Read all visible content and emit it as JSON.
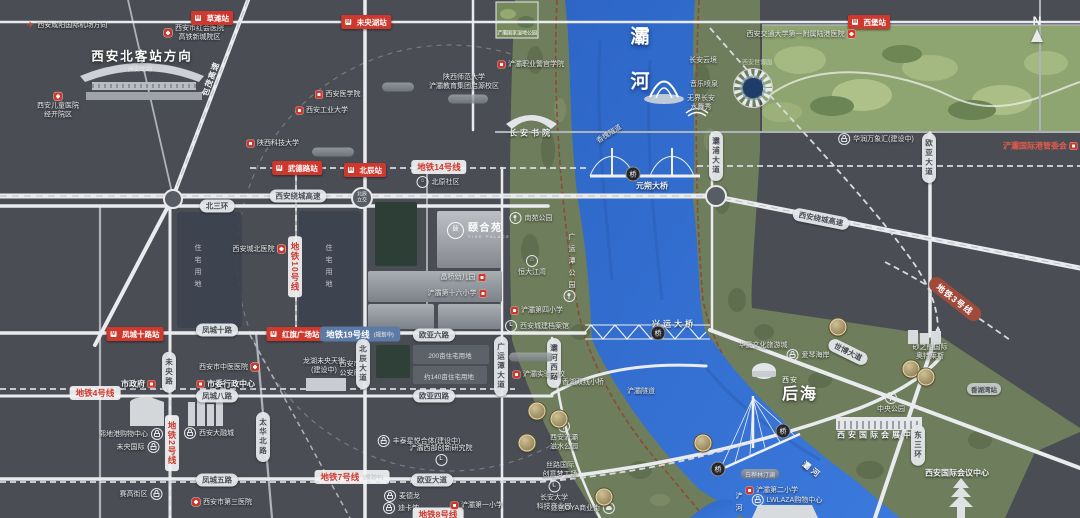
{
  "colors": {
    "map_bg": "#4a4e54",
    "river": "#3570cf",
    "corridor_green": "#6e7d5b",
    "expo_green": "#8ea471",
    "station_red": "#cf382c",
    "metro19_blue": "#5b7aa6",
    "metro3_brown": "#a04a3b",
    "gold_badge": "#c9b98c",
    "greenway": "#8a4c38"
  },
  "project": {
    "name": "颐合苑",
    "en": "YIHE PALACE"
  },
  "labels": [
    {
      "n": "airport-direction",
      "c": "pls",
      "t": "西安咸阳国际机场方向",
      "x": 67,
      "y": 25,
      "icon": "plane",
      "ip": "l"
    },
    {
      "n": "honghui-hospital",
      "c": "pls",
      "lines": [
        "西安市红会医院",
        "高铁新城院区"
      ],
      "x": 194,
      "y": 33,
      "icon": "cross",
      "ip": "l"
    },
    {
      "n": "station-caotan",
      "c": "st",
      "t": "草滩站",
      "x": 212,
      "y": 18
    },
    {
      "n": "station-weiyanghu",
      "c": "st",
      "t": "未央湖站",
      "x": 366,
      "y": 22
    },
    {
      "n": "station-xipu",
      "c": "st",
      "t": "西堡站",
      "x": 869,
      "y": 22
    },
    {
      "n": "north-station-direction",
      "c": "plb",
      "t": "西安北客站方向",
      "x": 142,
      "y": 55
    },
    {
      "n": "north-station-name",
      "c": "fade",
      "t": "西安北站",
      "x": 140,
      "y": 69
    },
    {
      "n": "children-hospital",
      "c": "pls col",
      "lines": [
        "西安儿童医院",
        "经开院区"
      ],
      "x": 58,
      "y": 106,
      "icon": "cross",
      "ip": "t"
    },
    {
      "n": "baomao-expressway",
      "c": "rdt",
      "t": "包茂高速",
      "x": 211,
      "y": 79,
      "rot": -70
    },
    {
      "n": "xian-medical-college",
      "c": "pls",
      "t": "西安医学院",
      "x": 338,
      "y": 94,
      "icon": "school",
      "ip": "l"
    },
    {
      "n": "xian-technological-university",
      "c": "pls",
      "t": "西安工业大学",
      "x": 322,
      "y": 110,
      "icon": "school",
      "ip": "l"
    },
    {
      "n": "shaanxi-ust",
      "c": "pls",
      "t": "陕西科技大学",
      "x": 273,
      "y": 143,
      "icon": "school",
      "ip": "l"
    },
    {
      "n": "station-wudelu",
      "c": "st",
      "t": "武德路站",
      "x": 297,
      "y": 168
    },
    {
      "n": "metro-line-14",
      "c": "mt14",
      "t": "地铁14号线",
      "x": 439,
      "y": 167
    },
    {
      "n": "station-beichen",
      "c": "st",
      "t": "北辰站",
      "x": 365,
      "y": 170
    },
    {
      "n": "beiyuan-community",
      "c": "pls",
      "t": "北原社区",
      "x": 438,
      "y": 182,
      "icon": "home",
      "ip": "l"
    },
    {
      "n": "beichen-interchange",
      "c": "circ",
      "lines": [
        "北辰",
        "立交"
      ],
      "x": 362,
      "y": 198
    },
    {
      "n": "ring-expressway-west",
      "c": "rd",
      "t": "西安绕城高速",
      "x": 298,
      "y": 196
    },
    {
      "n": "north-3rd-ring",
      "c": "rd",
      "t": "北三环",
      "x": 217,
      "y": 206
    },
    {
      "n": "residential-zone-1",
      "c": "zone",
      "t": "住宅用地",
      "x": 197,
      "y": 268
    },
    {
      "n": "residential-zone-2",
      "c": "zone",
      "t": "住宅用地",
      "x": 328,
      "y": 268
    },
    {
      "n": "chengbei-hospital",
      "c": "pls",
      "t": "西安城北医院",
      "x": 259,
      "y": 249,
      "icon": "cross",
      "ip": "r"
    },
    {
      "n": "metro-line-10",
      "c": "mt14 v",
      "t": "地铁10号线",
      "x": 295,
      "y": 267
    },
    {
      "n": "station-fengchengshilu",
      "c": "st",
      "t": "凤城十路站",
      "x": 135,
      "y": 334
    },
    {
      "n": "fengcheng-10-road",
      "c": "rd",
      "t": "凤城十路",
      "x": 217,
      "y": 330
    },
    {
      "n": "station-hongqi-square",
      "c": "st",
      "t": "红旗广场站",
      "x": 295,
      "y": 334
    },
    {
      "n": "metro-line-19",
      "c": "mtb",
      "t": "地铁19号线",
      "x": 360,
      "y": 334,
      "tag": "(规划中)"
    },
    {
      "n": "ouya-6-road",
      "c": "rd",
      "t": "欧亚六路",
      "x": 434,
      "y": 335
    },
    {
      "n": "metro-line-4",
      "c": "mt14",
      "t": "地铁4号线",
      "x": 95,
      "y": 393
    },
    {
      "n": "city-government",
      "c": "pl",
      "t": "市政府",
      "x": 138,
      "y": 384,
      "icon": "school",
      "ip": "r"
    },
    {
      "n": "municipal-admin-center",
      "c": "pl",
      "t": "市委行政中心",
      "x": 226,
      "y": 384,
      "icon": "school",
      "ip": "l"
    },
    {
      "n": "tcm-hospital",
      "c": "pls",
      "t": "西安市中医医院",
      "x": 229,
      "y": 367,
      "icon": "cross",
      "ip": "r"
    },
    {
      "n": "fengcheng-8-road",
      "c": "rd",
      "t": "凤城八路",
      "x": 217,
      "y": 396
    },
    {
      "n": "weiyang-road",
      "c": "rdv",
      "t": "未央路",
      "x": 169,
      "y": 372
    },
    {
      "n": "metro-line-2",
      "c": "mt14 v",
      "t": "地铁2号线",
      "x": 172,
      "y": 443
    },
    {
      "n": "taihua-north-road",
      "c": "rdv",
      "t": "太华北路",
      "x": 263,
      "y": 437
    },
    {
      "n": "xidigang-mall",
      "c": "pls",
      "t": "熙地港购物中心",
      "x": 131,
      "y": 434,
      "icon": "bag",
      "ip": "r"
    },
    {
      "n": "weiyang-international",
      "c": "pls",
      "t": "未央国际",
      "x": 138,
      "y": 447,
      "icon": "bag",
      "ip": "r"
    },
    {
      "n": "darongcheng-mall",
      "c": "pls",
      "t": "西安大融城",
      "x": 209,
      "y": 433,
      "icon": "bag",
      "ip": "l"
    },
    {
      "n": "longfor-tianjie",
      "c": "pls col",
      "lines": [
        "龙湖未央天街",
        "(建设中)"
      ],
      "x": 324,
      "y": 366
    },
    {
      "n": "public-security-bureau",
      "c": "pls col",
      "lines": [
        "西安市",
        "公安局"
      ],
      "x": 350,
      "y": 369
    },
    {
      "n": "fengcheng-5-road",
      "c": "rd",
      "t": "凤城五路",
      "x": 217,
      "y": 480
    },
    {
      "n": "metro-line-7",
      "c": "mt14",
      "t": "地铁7号线",
      "x": 352,
      "y": 477,
      "tag": "(规划中)"
    },
    {
      "n": "ouya-avenue",
      "c": "rd",
      "t": "欧亚大道",
      "x": 432,
      "y": 480
    },
    {
      "n": "saigao-block",
      "c": "pls",
      "t": "赛高街区",
      "x": 141,
      "y": 494,
      "icon": "bag",
      "ip": "r"
    },
    {
      "n": "third-hospital",
      "c": "pls",
      "t": "西安市第三医院",
      "x": 222,
      "y": 502,
      "icon": "cross",
      "ip": "l"
    },
    {
      "n": "metro-shop",
      "c": "pls",
      "t": "麦德龙",
      "x": 402,
      "y": 496,
      "icon": "bag",
      "ip": "l"
    },
    {
      "n": "decathlon",
      "c": "pls",
      "t": "迪卡侬",
      "x": 401,
      "y": 508,
      "icon": "bag",
      "ip": "l"
    },
    {
      "n": "metro-line-8",
      "c": "mt14 clip",
      "t": "地铁8号线",
      "x": 438,
      "y": 516
    },
    {
      "n": "chanba-no1-primary",
      "c": "pls",
      "t": "浐灞第一小学",
      "x": 477,
      "y": 505,
      "icon": "school",
      "ip": "l"
    },
    {
      "n": "fengtai-complex",
      "c": "pls",
      "t": "丰泰星悦合体(建设中)",
      "x": 419,
      "y": 441,
      "icon": "bag",
      "ip": "l"
    },
    {
      "n": "chanba-west-institute",
      "c": "pls col",
      "lines": [
        "浐灞西部创新研究院"
      ],
      "x": 441,
      "y": 455,
      "icon": "lic",
      "ip": "b"
    },
    {
      "n": "plot-200mu",
      "c": "blockt",
      "t": "200亩住宅用地",
      "x": 450,
      "y": 355
    },
    {
      "n": "plot-140mu",
      "c": "blockt",
      "t": "约140亩住宅用地",
      "x": 449,
      "y": 376
    },
    {
      "n": "beichen-avenue",
      "c": "rdv",
      "t": "北辰大道",
      "x": 363,
      "y": 364
    },
    {
      "n": "guangyuntan-avenue",
      "c": "rdv",
      "t": "广运潭大道",
      "x": 501,
      "y": 366
    },
    {
      "n": "bahe-west-road",
      "c": "rdv",
      "t": "灞河西路",
      "x": 554,
      "y": 363
    },
    {
      "n": "ouya-4-road",
      "c": "rd",
      "t": "欧亚四路",
      "x": 434,
      "y": 396
    },
    {
      "n": "zhaoshang-plot",
      "c": "emb",
      "t": "",
      "x": 531,
      "y": 357,
      "w": 44
    },
    {
      "n": "chanba-experimental-school",
      "c": "pls",
      "t": "浐灞实验学校",
      "x": 539,
      "y": 374,
      "icon": "school",
      "ip": "l"
    },
    {
      "n": "hengda-jiangwan",
      "c": "pls col",
      "lines": [
        "恒大江湾"
      ],
      "x": 532,
      "y": 266,
      "icon": "home",
      "ip": "t"
    },
    {
      "n": "nanyuan-park",
      "c": "pls",
      "t": "南苑公园",
      "x": 531,
      "y": 218,
      "icon": "tree",
      "ip": "l"
    },
    {
      "n": "jingqiao-kindergarten",
      "c": "pls",
      "t": "晶桥幼儿园",
      "x": 463,
      "y": 277,
      "icon": "school",
      "ip": "r"
    },
    {
      "n": "chanba-no16-primary",
      "c": "pls",
      "t": "浐灞第十六小学",
      "x": 457,
      "y": 293,
      "icon": "school",
      "ip": "r"
    },
    {
      "n": "chanba-no4-primary",
      "c": "pls",
      "t": "浐灞第四小学",
      "x": 537,
      "y": 310,
      "icon": "school",
      "ip": "l"
    },
    {
      "n": "urban-archives",
      "c": "pls",
      "t": "西安城建档案馆",
      "x": 537,
      "y": 326,
      "icon": "lic",
      "ip": "l"
    },
    {
      "n": "guangyuntan-park",
      "c": "zone g",
      "t": "广运潭公园",
      "x": 571,
      "y": 263
    },
    {
      "n": "guangyuntan-park-icon",
      "c": "pls",
      "t": "",
      "x": 571,
      "y": 296,
      "icon": "tree",
      "ip": "l"
    },
    {
      "n": "shaanxi-normal-univ",
      "c": "pls col",
      "lines": [
        "陕西师范大学",
        "浐灞教育集团启源校区"
      ],
      "x": 464,
      "y": 82
    },
    {
      "n": "police-vocational-college",
      "c": "pls",
      "t": "浐灞职业警官学院",
      "x": 531,
      "y": 64,
      "icon": "school",
      "ip": "l"
    },
    {
      "n": "changan-academy",
      "c": "pl sp",
      "t": "长安书院",
      "x": 531,
      "y": 133
    },
    {
      "n": "wetland-park-caption",
      "c": "thumbc",
      "t": "浐灞国家湿地公园",
      "x": 517,
      "y": 33
    },
    {
      "n": "emboss-1",
      "c": "emb",
      "t": "",
      "x": 398,
      "y": 87,
      "w": 32
    },
    {
      "n": "emboss-2",
      "c": "emb",
      "t": "",
      "x": 468,
      "y": 99,
      "w": 40
    },
    {
      "n": "emboss-3",
      "c": "emb",
      "t": "",
      "x": 333,
      "y": 152,
      "w": 42
    },
    {
      "n": "bahe-river-title",
      "c": "ttl",
      "lines": [
        "灞",
        "河"
      ],
      "x": 640,
      "y": 60
    },
    {
      "n": "music-fountain",
      "c": "pls",
      "t": "音乐喷泉",
      "x": 704,
      "y": 84
    },
    {
      "n": "changan-cloud",
      "c": "pls",
      "t": "长安云境",
      "x": 703,
      "y": 60
    },
    {
      "n": "wujie-changan-show",
      "c": "pls col",
      "lines": [
        "无界长安",
        "水舞秀"
      ],
      "x": 701,
      "y": 103
    },
    {
      "n": "expo-park-name",
      "c": "fade",
      "t": "西安世博园",
      "x": 757,
      "y": 62
    },
    {
      "n": "jiaotong-univ-hospital",
      "c": "pls",
      "t": "西安交通大学第一附属陆港医院",
      "x": 801,
      "y": 34,
      "icon": "cross",
      "ip": "r"
    },
    {
      "n": "mixc-mall",
      "c": "pls",
      "t": "华润万象汇(建设中)",
      "x": 876,
      "y": 139,
      "icon": "bag",
      "ip": "l"
    },
    {
      "n": "port-committee",
      "c": "red",
      "t": "浐灞国际港管委会",
      "x": 1040,
      "y": 146,
      "icon": "school",
      "ip": "r"
    },
    {
      "n": "compass",
      "c": "comp col",
      "t": "N",
      "x": 1037,
      "y": 28
    },
    {
      "n": "yuanshuo-bridge",
      "c": "pl",
      "t": "元朔大桥",
      "x": 652,
      "y": 186
    },
    {
      "n": "bridge-badge-1",
      "c": "bdg",
      "t": "桥",
      "x": 633,
      "y": 174
    },
    {
      "n": "xinghuai-tunnel",
      "c": "pls",
      "t": "香槐隧道",
      "x": 609,
      "y": 134,
      "rot": -33
    },
    {
      "n": "ring-expressway-east",
      "c": "rd",
      "t": "西安绕城高速",
      "x": 821,
      "y": 219,
      "rot": 11
    },
    {
      "n": "bapu-avenue",
      "c": "rdv",
      "t": "灞浦大道",
      "x": 716,
      "y": 156
    },
    {
      "n": "ouya-avenue-north",
      "c": "rdv",
      "t": "欧亚大道",
      "x": 929,
      "y": 158
    },
    {
      "n": "metro-line-3",
      "c": "mt3",
      "t": "地铁3号线",
      "x": 955,
      "y": 299,
      "rot": 38
    },
    {
      "n": "xingyun-bridge",
      "c": "pl sp",
      "t": "兴运大桥",
      "x": 674,
      "y": 324
    },
    {
      "n": "bridge-badge-2",
      "c": "bdg",
      "t": "桥",
      "x": 658,
      "y": 333
    },
    {
      "n": "huaxia-cultural-town",
      "c": "pls",
      "t": "华夏文化旅游城",
      "x": 763,
      "y": 345
    },
    {
      "n": "aegean-coast",
      "c": "pls",
      "t": "爱琴海岸",
      "x": 808,
      "y": 355,
      "icon": "bag",
      "ip": "l"
    },
    {
      "n": "expo-avenue",
      "c": "rd",
      "t": "世博大道",
      "x": 848,
      "y": 352,
      "rot": 26
    },
    {
      "n": "sasseur-outlets",
      "c": "pls col",
      "lines": [
        "砂之船国际",
        "奥特莱斯"
      ],
      "x": 930,
      "y": 352
    },
    {
      "n": "station-xianghuwan",
      "c": "rd sm",
      "t": "香湖湾站",
      "x": 984,
      "y": 389
    },
    {
      "n": "central-park",
      "c": "pls col",
      "lines": [
        "中央公园"
      ],
      "x": 891,
      "y": 403,
      "icon": "tree",
      "ip": "t"
    },
    {
      "n": "intl-convention-exhibition-center",
      "c": "pl sp",
      "t": "西安国际会展中心",
      "x": 881,
      "y": 435
    },
    {
      "n": "east-3rd-ring",
      "c": "rdv",
      "t": "东三环",
      "x": 918,
      "y": 445
    },
    {
      "n": "intl-conference-center",
      "c": "pl",
      "t": "西安国际会议中心",
      "x": 957,
      "y": 473
    },
    {
      "n": "houhai-title",
      "c": "ttl2",
      "lines": [
        "西安",
        "后海"
      ],
      "x": 800,
      "y": 391
    },
    {
      "n": "bridge-badge-3",
      "c": "bdg",
      "t": "桥",
      "x": 783,
      "y": 431
    },
    {
      "n": "bridge-badge-4",
      "c": "bdg",
      "t": "桥",
      "x": 718,
      "y": 469
    },
    {
      "n": "chanba-tunnel",
      "c": "pls",
      "t": "浐灞隧道",
      "x": 641,
      "y": 391
    },
    {
      "n": "twin-bridge",
      "c": "pls",
      "t": "香湖双线小桥",
      "x": 583,
      "y": 382
    },
    {
      "n": "zishui-park",
      "c": "pls col",
      "lines": [
        "西安浐灞",
        "滋水公园"
      ],
      "x": 564,
      "y": 436,
      "icon": "tree",
      "ip": "l"
    },
    {
      "n": "silk-road-dream-works",
      "c": "pls col",
      "lines": [
        "丝路国际",
        "创意梦工场"
      ],
      "x": 560,
      "y": 470
    },
    {
      "n": "changan-univ-tech-park",
      "c": "pls col",
      "lines": [
        "长安大学",
        "科技产业园"
      ],
      "x": 554,
      "y": 496,
      "icon": "lic",
      "ip": "l"
    },
    {
      "n": "oya-commercial-street",
      "c": "pls",
      "t": "途创OYA商业街",
      "x": 583,
      "y": 508,
      "icon": "car",
      "ip": "r"
    },
    {
      "n": "baihualin-tinglan",
      "c": "emb t",
      "t": "白桦林汀澜",
      "x": 760,
      "y": 474
    },
    {
      "n": "chanba-no2-primary",
      "c": "pls",
      "t": "浐灞第二小学",
      "x": 772,
      "y": 490,
      "icon": "school",
      "ip": "l"
    },
    {
      "n": "lwlaza-mall",
      "c": "pls",
      "t": "LWLAZA购物中心",
      "x": 787,
      "y": 500,
      "icon": "bag",
      "ip": "l"
    },
    {
      "n": "chanhe-river-label",
      "c": "zone g",
      "t": "浐河",
      "x": 738,
      "y": 504
    },
    {
      "n": "bahe-river-label-2",
      "c": "pl sp",
      "t": "灞河",
      "x": 812,
      "y": 470,
      "rot": 38
    },
    {
      "n": "gold-badge-1",
      "c": "gold",
      "t": "",
      "x": 537,
      "y": 411
    },
    {
      "n": "gold-badge-2",
      "c": "gold",
      "t": "",
      "x": 559,
      "y": 419
    },
    {
      "n": "gold-badge-3",
      "c": "gold",
      "t": "",
      "x": 527,
      "y": 443
    },
    {
      "n": "gold-badge-4",
      "c": "gold",
      "t": "",
      "x": 604,
      "y": 497
    },
    {
      "n": "gold-badge-5",
      "c": "gold",
      "t": "",
      "x": 838,
      "y": 327
    },
    {
      "n": "gold-badge-6",
      "c": "gold",
      "t": "",
      "x": 911,
      "y": 369
    },
    {
      "n": "gold-badge-7",
      "c": "gold",
      "t": "",
      "x": 926,
      "y": 377
    },
    {
      "n": "gold-badge-8",
      "c": "gold",
      "t": "",
      "x": 703,
      "y": 443
    }
  ]
}
